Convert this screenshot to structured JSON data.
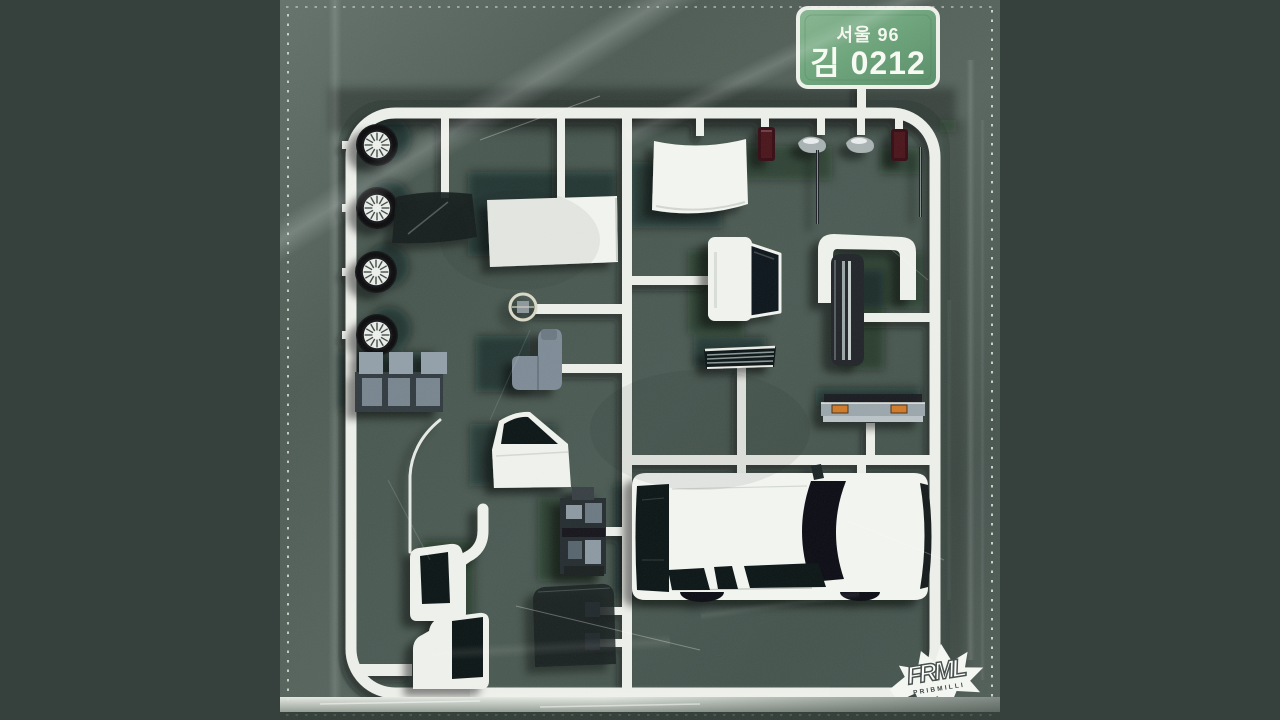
{
  "scene": {
    "description": "Album artwork: a plastic model-kit sprue of white van parts sealed in a clear plastic bag over a dark green backing card",
    "background_color": "#36413d",
    "bag_color": "#55635c",
    "card_color": "#43534c",
    "sprue_color": "#eceee9"
  },
  "license_plate": {
    "region_line": "서울 96",
    "number_line": "김 0212",
    "plate_color": "#6fa57d",
    "border_color": "#eef2ea",
    "text_color": "#f4f7ef"
  },
  "logo": {
    "brand": "FRML",
    "crew": "PRIBMILLI",
    "color": "#f4f6f2"
  },
  "parts": [
    "wheel x4",
    "tinted windshield glass",
    "white roof panel",
    "steering wheel",
    "driver seat",
    "bench seat row",
    "front door with window",
    "engine block",
    "cab body outline",
    "cab quarter panel with window",
    "cab door panel with window",
    "tinted door glass",
    "side mirror stubs x2",
    "curved white windshield",
    "red tail lamp x2",
    "chrome side mirror x2",
    "antenna rod x2",
    "crt tv console",
    "radiator",
    "front grille",
    "rear bumper with orange indicators",
    "white van body shell"
  ]
}
